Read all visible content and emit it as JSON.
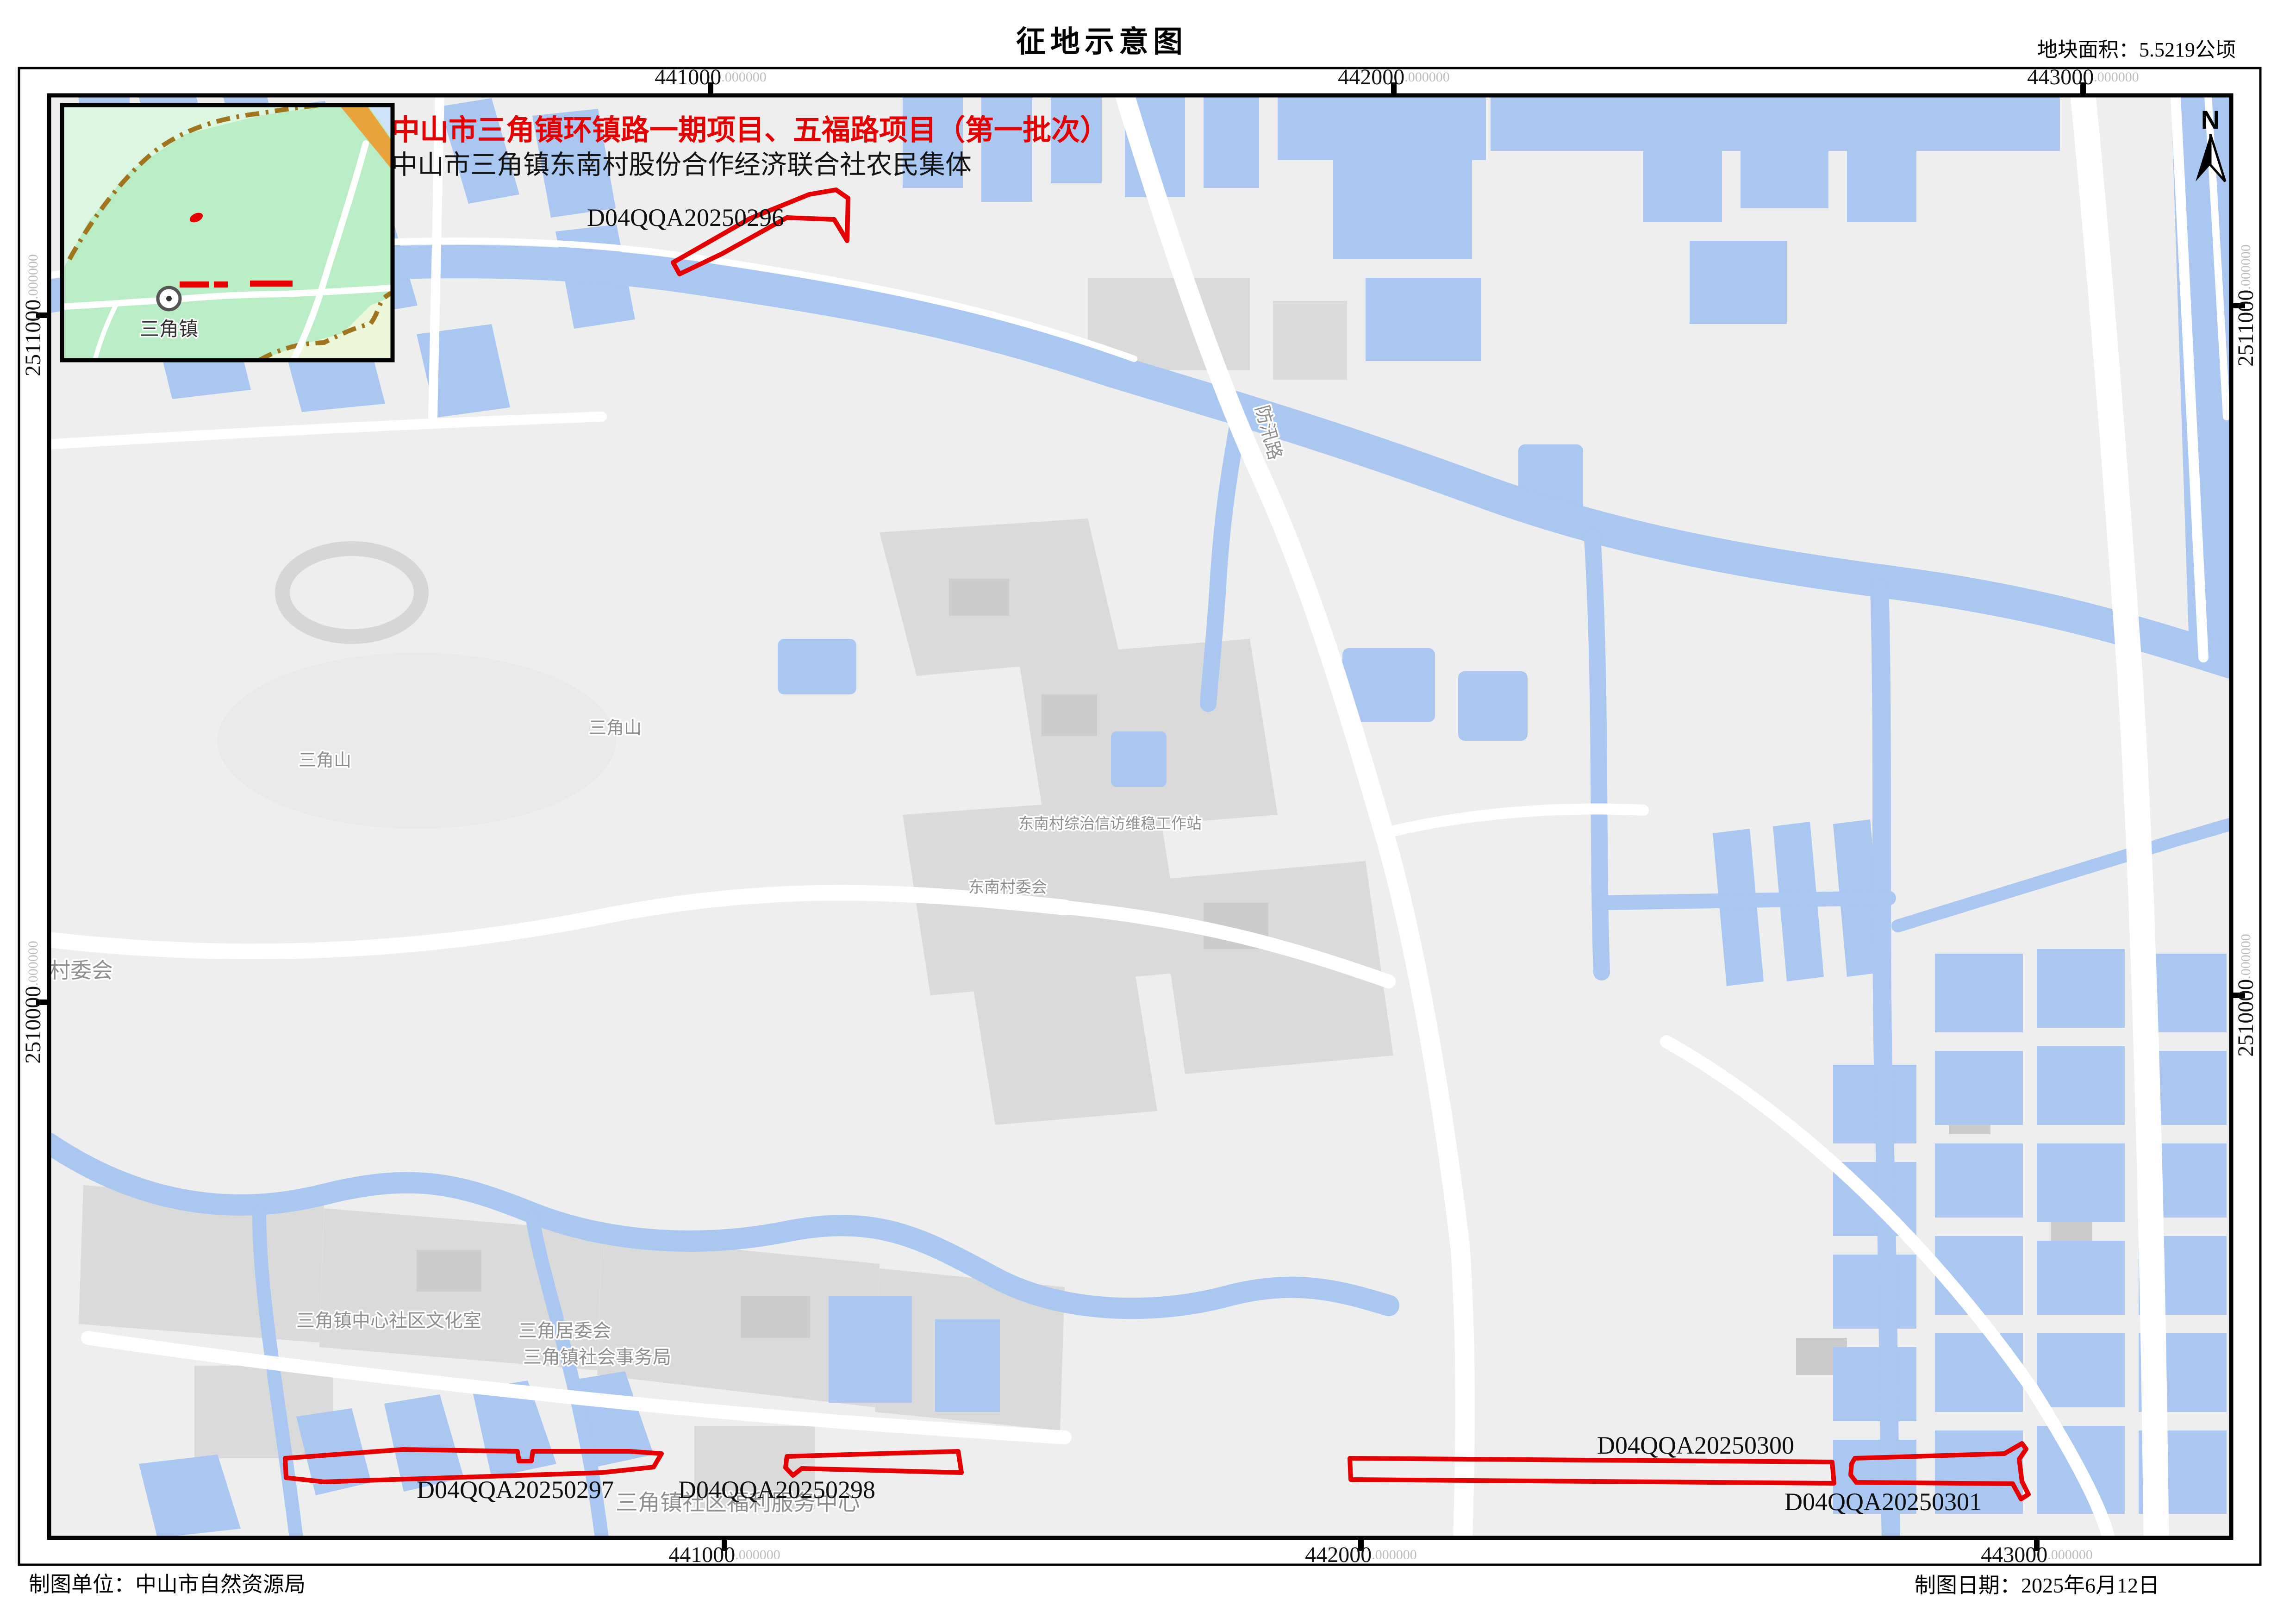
{
  "sheet": {
    "title": "征地示意图",
    "area_note": "地块面积：5.5219公顷",
    "footer_left": "制图单位：中山市自然资源局",
    "footer_right": "制图日期：2025年6月12日"
  },
  "map": {
    "project_title": "中山市三角镇环镇路一期项目、五福路项目（第一批次）",
    "project_subtitle": "中山市三角镇东南村股份合作经济联合社农民集体",
    "north_label": "N",
    "parcels": [
      {
        "id": "D04QQA20250296"
      },
      {
        "id": "D04QQA20250297"
      },
      {
        "id": "D04QQA20250298"
      },
      {
        "id": "D04QQA20250300"
      },
      {
        "id": "D04QQA20250301"
      }
    ],
    "labels": {
      "hill1": "三角山",
      "hill2": "三角山",
      "workstation": "东南村综治信访维稳工作站",
      "village_committee": "东南村委会",
      "village_committee_partial": "角村委会",
      "culture_room": "三角镇中心社区文化室",
      "residents_committee": "三角居委会",
      "social_affairs": "三角镇社会事务局",
      "welfare_center": "三角镇社区福利服务中心",
      "road_flood": "防汛路"
    },
    "inset": {
      "town": "三角镇"
    },
    "coords": {
      "suffix": ".000000",
      "easting": [
        {
          "v": "441000"
        },
        {
          "v": "442000"
        },
        {
          "v": "443000"
        }
      ],
      "northing": [
        {
          "v": "2511000"
        },
        {
          "v": "2510000"
        }
      ]
    }
  },
  "colors": {
    "water": "#a9c7f0",
    "background": "#eeeeee",
    "buildings": "#dadada",
    "road_white": "#ffffff",
    "parcel_red": "#e60000",
    "boundary_brown": "#a0751c",
    "inset_green": "#b9edc5",
    "inset_green_light": "#dcf6e2",
    "inset_yellow_green": "#ecf6d8",
    "orange_road": "#e8a33d",
    "label_gray": "#8f8f8f"
  }
}
